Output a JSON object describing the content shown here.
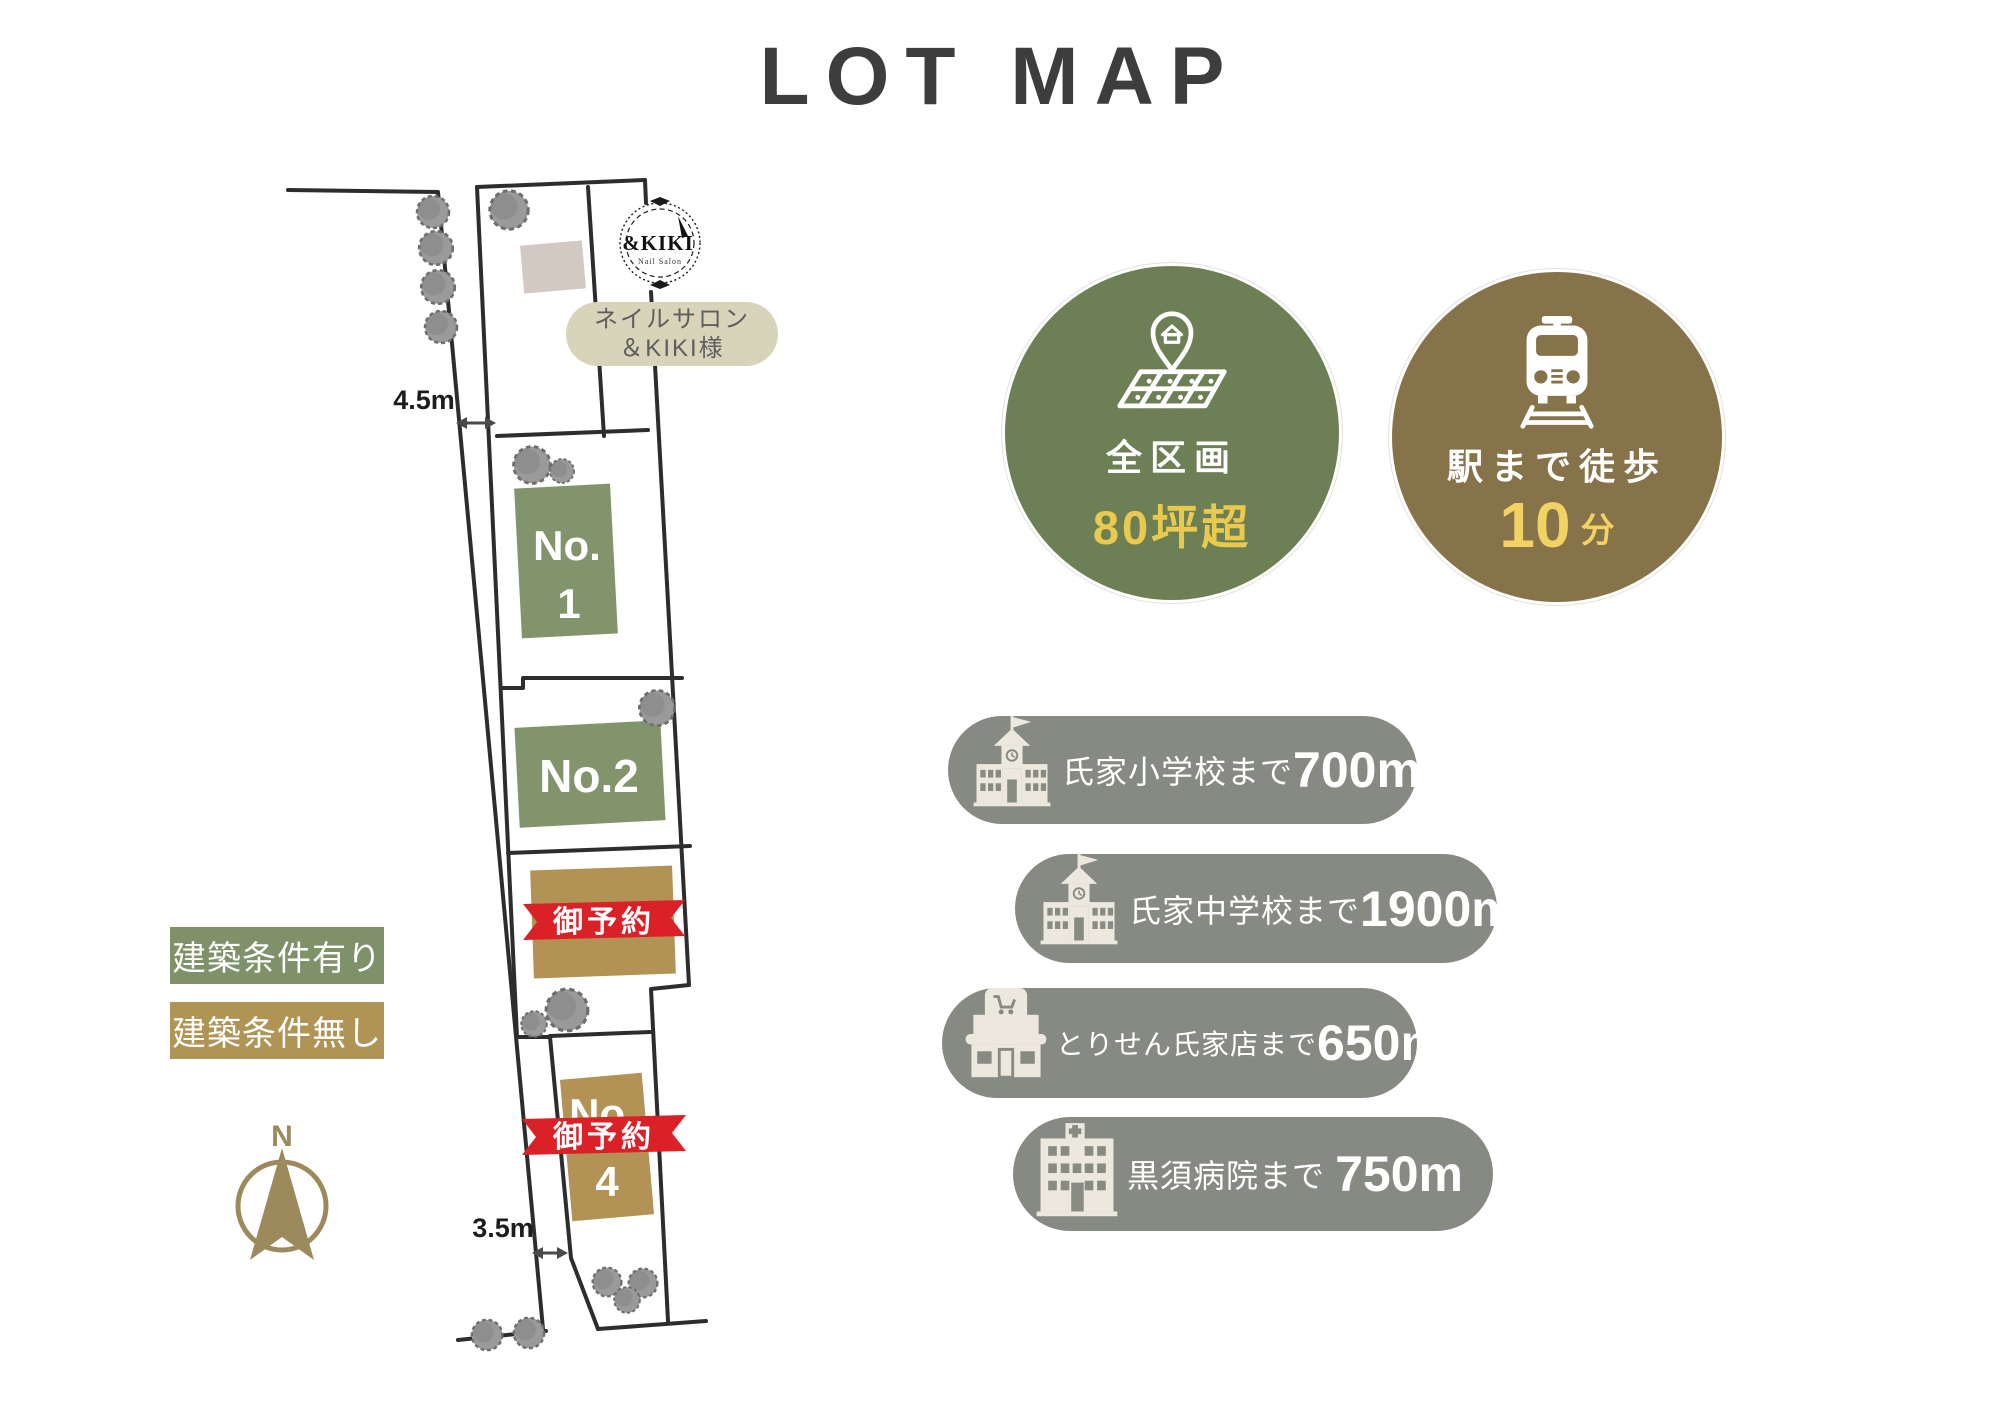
{
  "title": "LOT MAP",
  "colors": {
    "lot_available_green": "#81946c",
    "lot_no_condition_tan": "#b29355",
    "reserved_ribbon_red": "#da2127",
    "badge_area_green": "#6d7f55",
    "badge_station_brown": "#867349",
    "accent_yellow": "#eac94f",
    "facility_pill_gray": "#868a82",
    "compass_gold": "#9c8a5c"
  },
  "map": {
    "dimension_top": "4.5m",
    "dimension_bottom": "3.5m",
    "compass_label": "N",
    "salon_logo": {
      "brand": "&KIKI",
      "tagline": "Nail Salon"
    },
    "salon_label": {
      "line1": "ネイルサロン",
      "line2": "＆KIKI様"
    },
    "lots": [
      {
        "no_prefix": "No.",
        "number": "1"
      },
      {
        "label": "No.2"
      },
      {
        "ribbon": "御予約"
      },
      {
        "no_prefix": "No.",
        "number": "4",
        "ribbon": "御予約"
      }
    ]
  },
  "legend": {
    "items": [
      {
        "label": "建築条件有り"
      },
      {
        "label": "建築条件無し"
      }
    ]
  },
  "badges": {
    "area": {
      "line1": "全区画",
      "line2": "80坪超"
    },
    "station": {
      "line1": "駅まで徒歩",
      "number": "10",
      "unit": "分"
    }
  },
  "facilities": [
    {
      "name": "氏家小学校まで",
      "distance": "700m"
    },
    {
      "name": "氏家中学校まで",
      "distance": "1900m"
    },
    {
      "name": "とりせん氏家店まで",
      "distance": "650m"
    },
    {
      "name": "黒須病院まで",
      "distance": "750m"
    }
  ]
}
